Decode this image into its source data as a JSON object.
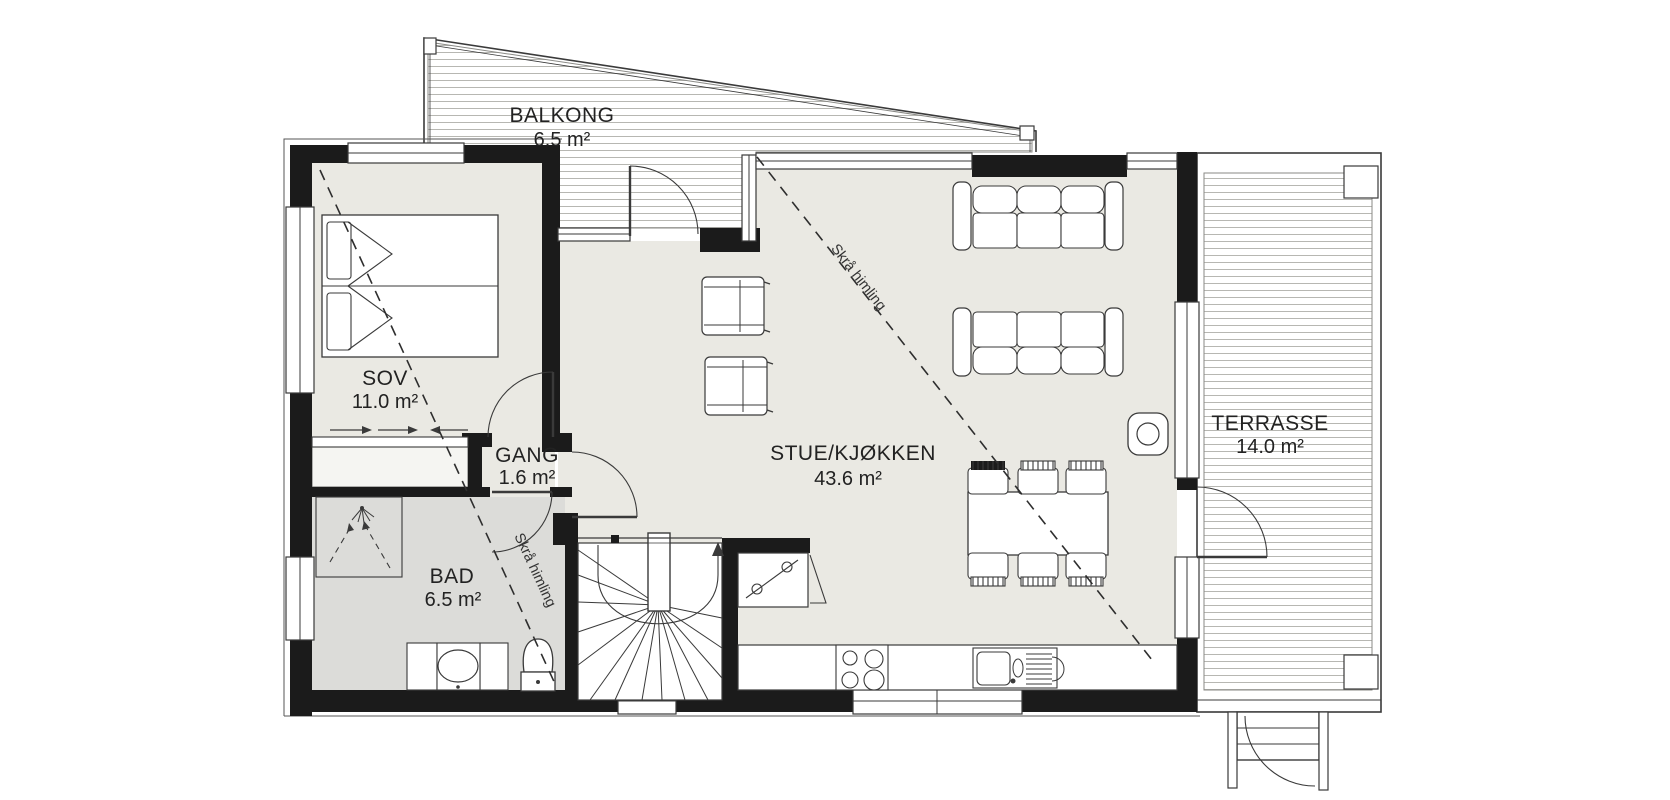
{
  "floorplan": {
    "rooms": [
      {
        "id": "balkong",
        "name": "BALKONG",
        "area": "6.5 m²"
      },
      {
        "id": "sov",
        "name": "SOV",
        "area": "11.0 m²"
      },
      {
        "id": "gang",
        "name": "GANG",
        "area": "1.6 m²"
      },
      {
        "id": "bad",
        "name": "BAD",
        "area": "6.5 m²"
      },
      {
        "id": "stue-kjokken",
        "name": "STUE/KJØKKEN",
        "area": "43.6 m²"
      },
      {
        "id": "terrasse",
        "name": "TERRASSE",
        "area": "14.0 m²"
      }
    ],
    "annotations": [
      {
        "id": "sloped-ceiling-left",
        "text": "Skrå himling"
      },
      {
        "id": "sloped-ceiling-right",
        "text": "Skrå himling"
      }
    ],
    "colors": {
      "wall": "#1b1b1b",
      "floor": "#eae9e3",
      "floor_bath": "#dcdcd9",
      "closet": "#f5f5f2",
      "line": "#444444",
      "hatch": "#b7b7b2",
      "background": "#ffffff"
    },
    "furniture": [
      "double-bed",
      "wardrobe-sliding",
      "shower",
      "vanity-sink",
      "toilet",
      "winder-staircase",
      "kitchen-counter",
      "cooktop",
      "kitchen-sink",
      "tall-cabinet",
      "dining-table",
      "dining-chairs",
      "sofa",
      "sofa",
      "armchair",
      "armchair",
      "fireplace",
      "terrace-steps"
    ]
  }
}
